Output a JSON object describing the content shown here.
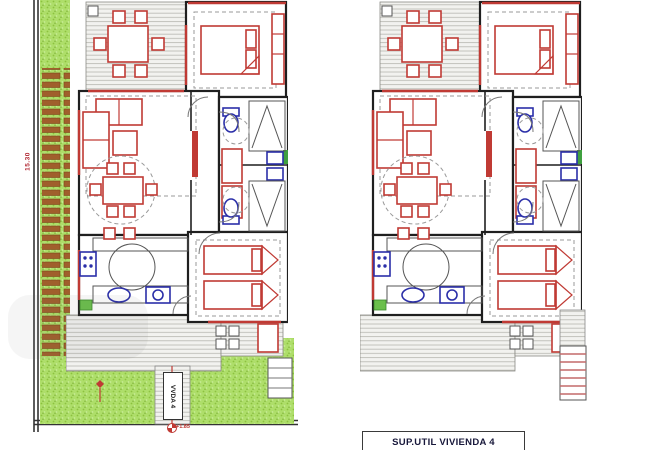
{
  "drawing": {
    "type": "architectural floor plan, two mirrored villa units",
    "title_box": {
      "label": "SUP.UTIL VIVIENDA 4"
    },
    "left_unit": {
      "walkway_label": "VVDA 4",
      "boundary_dimension": "15.30",
      "level_marker": "+1.85"
    },
    "colors": {
      "grass_green": "#aede6a",
      "slat_brown": "#a05f2c",
      "deck_gray": "#f2f2ef",
      "wall_black": "#1f1f1f",
      "furniture_red": "#c03a34",
      "fixture_blue": "#2b2fa8",
      "window_green": "#3fa03f",
      "marker_red": "#c03a34"
    }
  }
}
